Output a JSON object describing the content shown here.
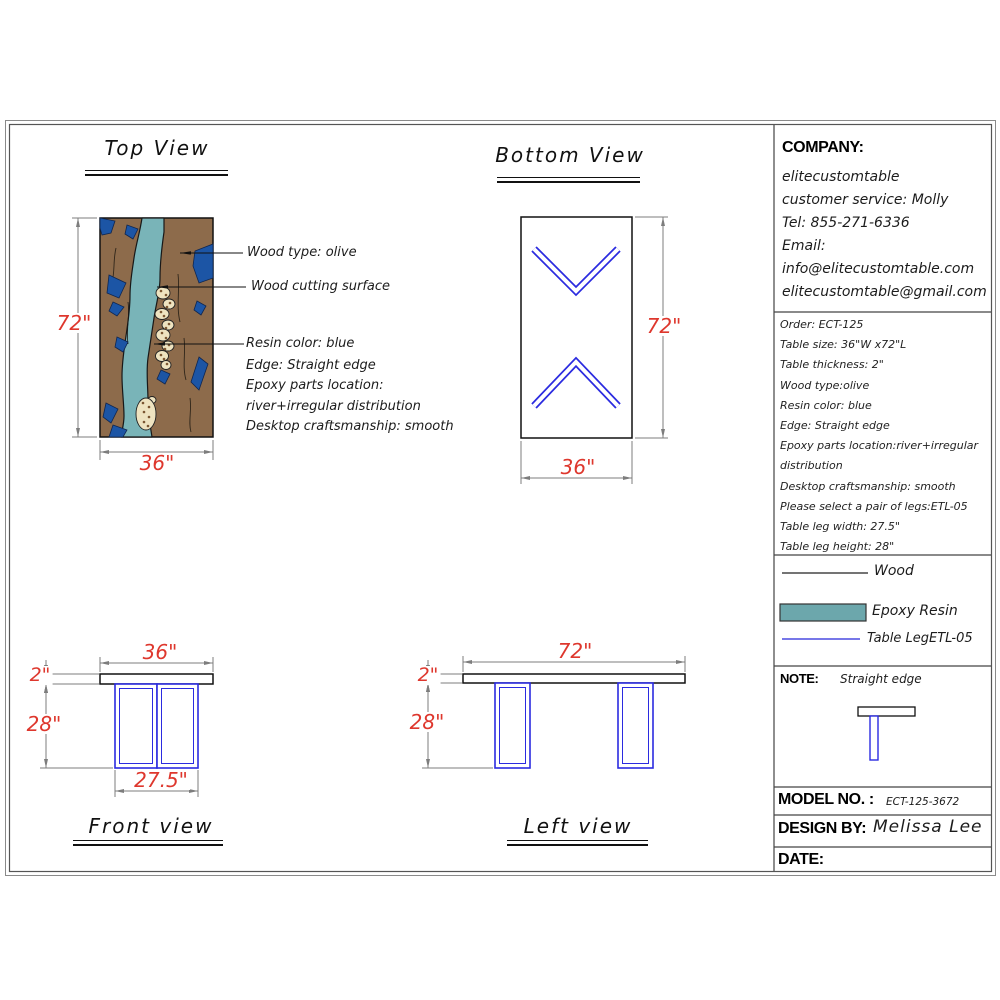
{
  "colors": {
    "dim_text_red": "#de372d",
    "dim_line_gray": "#7d7d7d",
    "leg_blue": "#2b2be0",
    "legend_leg_blue": "#4a4ae0",
    "wood_brown": "#8d6b4b",
    "river_teal": "#79b4b8",
    "patch_blue": "#1c55a5",
    "stone_cream": "#eee3c0",
    "resin_swatch": "#6ca7ac"
  },
  "views": {
    "top": {
      "title": "Top View",
      "height_dim": "72\"",
      "width_dim": "36\""
    },
    "bottom": {
      "title": "Bottom View",
      "height_dim": "72\"",
      "width_dim": "36\""
    },
    "front": {
      "title": "Front view",
      "width_dim": "36\"",
      "thickness_dim": "2\"",
      "leg_height_dim": "28\"",
      "leg_width_dim": "27.5\""
    },
    "left": {
      "title": "Left view",
      "length_dim": "72\"",
      "thickness_dim": "2\"",
      "leg_height_dim": "28\""
    }
  },
  "annotations": {
    "leaders": [
      "Wood type: olive",
      "Wood cutting surface",
      "Resin color: blue"
    ],
    "specs": [
      "Edge: Straight edge",
      "Epoxy parts location:",
      "river+irregular distribution",
      "Desktop craftsmanship: smooth"
    ]
  },
  "panel": {
    "company": {
      "label": "COMPANY:",
      "lines": [
        "elitecustomtable",
        "customer service: Molly",
        "Tel: 855-271-6336",
        "Email:",
        "info@elitecustomtable.com",
        "elitecustomtable@gmail.com"
      ]
    },
    "order": {
      "lines": [
        "Order: ECT-125",
        "Table size: 36\"W x72\"L",
        "Table thickness: 2\"",
        "Wood type:olive",
        "Resin color: blue",
        "Edge: Straight edge",
        "Epoxy parts location:river+irregular",
        "distribution",
        "Desktop craftsmanship: smooth",
        "Please select a pair of legs:ETL-05",
        "Table leg width: 27.5\"",
        "Table leg height: 28\""
      ]
    },
    "legend": {
      "wood_label": "Wood",
      "resin_label": "Epoxy Resin",
      "leg_label": "Table LegETL-05"
    },
    "note": {
      "label": "NOTE:",
      "value": "Straight edge"
    },
    "model": {
      "label": "MODEL NO. :",
      "value": "ECT-125-3672"
    },
    "design": {
      "label": "DESIGN BY:",
      "value": "Melissa Lee"
    },
    "date": {
      "label": "DATE:"
    }
  }
}
